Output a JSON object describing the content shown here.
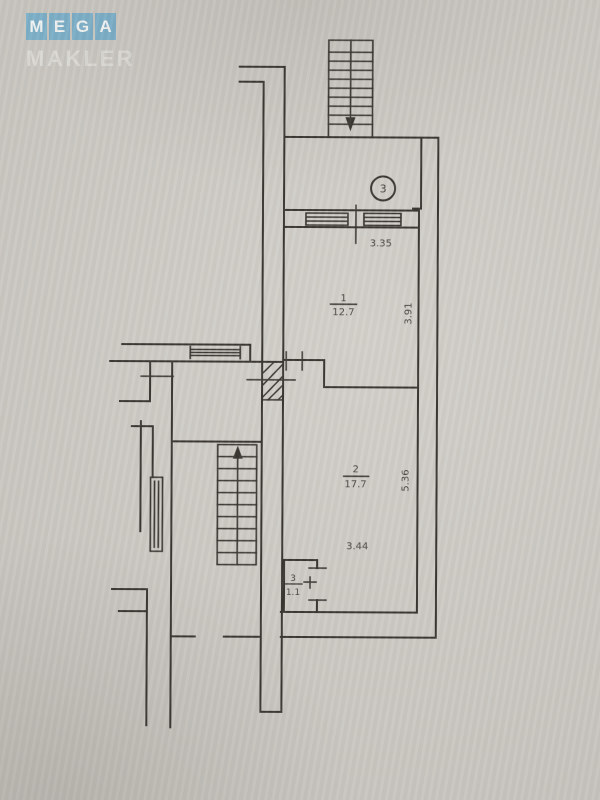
{
  "watermark": {
    "mega_letters": [
      "M",
      "E",
      "G",
      "A"
    ],
    "subtitle": "MAKLER",
    "tile_color": "#7db0c9",
    "letter_color": "#f1f3f2",
    "subtitle_color": "#dbdad4"
  },
  "plan": {
    "paper_color": "#cac7c1",
    "line_color": "#3b3833",
    "circle_symbol": "3",
    "rooms": [
      {
        "number": "1",
        "area": "12.7"
      },
      {
        "number": "2",
        "area": "17.7"
      },
      {
        "number": "3",
        "area": "1.1"
      }
    ],
    "dimensions": {
      "entry_width": "3.35",
      "room1_depth": "3.91",
      "room2_depth": "5.36",
      "room2_width": "3.44"
    }
  }
}
